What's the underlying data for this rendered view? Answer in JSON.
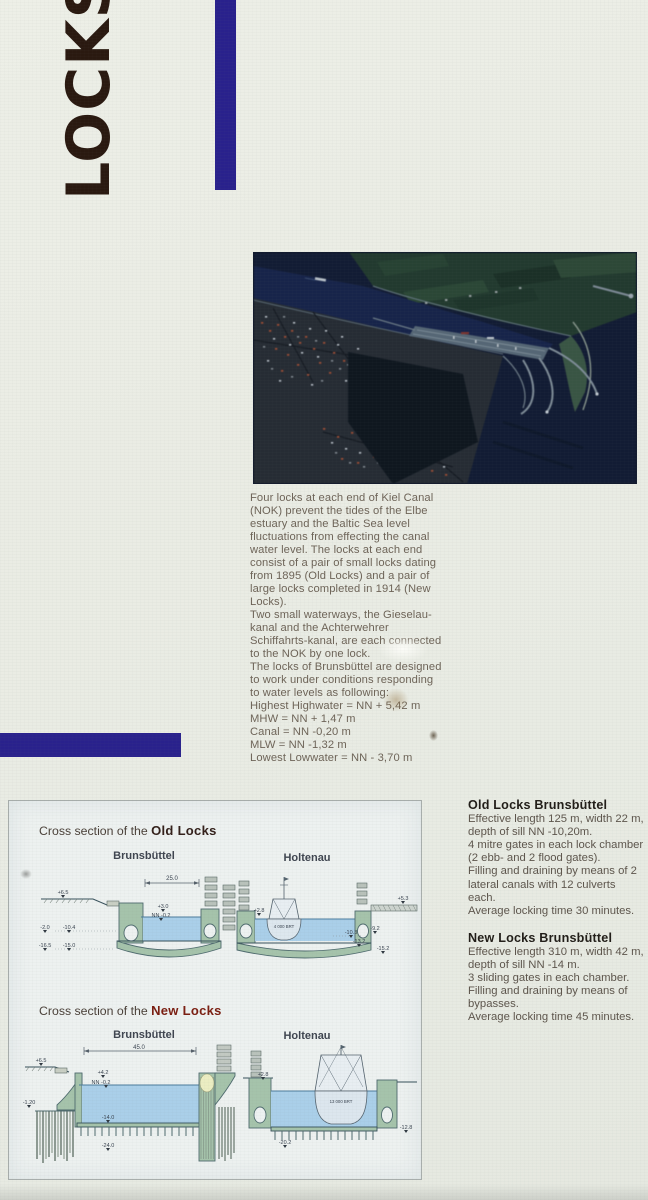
{
  "poster": {
    "title": "LOCKS"
  },
  "colors": {
    "accent_bar": "#29218c",
    "title_text": "#2a1910",
    "old_heading": "#33201a",
    "new_heading": "#7a1d10",
    "diagram_wall": "#a5c3ab",
    "diagram_water": "#aacfe9",
    "photo_water": "#16223f"
  },
  "intro": {
    "lines": [
      "Four locks at each end of Kiel Canal",
      "(NOK) prevent the tides of the Elbe",
      "estuary and the Baltic Sea level",
      "fluctuations from effecting the canal",
      "water level. The locks at each end",
      "consist of a pair of small locks dating",
      "from 1895 (Old Locks) and a pair of",
      "large locks completed in 1914 (New",
      "Locks).",
      "Two small waterways, the Gieselau-",
      "kanal and the Achterwehrer",
      "Schiffahrts-kanal, are each connected",
      "to the NOK by one lock.",
      "The locks of Brunsbüttel are designed",
      "to work under conditions responding",
      "to water levels as following:"
    ],
    "levels": [
      "Highest Highwater = NN + 5,42 m",
      "MHW = NN + 1,47 m",
      "Canal = NN -0,20 m",
      "MLW = NN -1,32 m",
      "Lowest Lowwater = NN - 3,70 m"
    ]
  },
  "info": {
    "old": {
      "heading": "Old Locks Brunsbüttel",
      "lines": [
        "Effective length 125 m, width 22 m,",
        "depth of sill NN -10,20m.",
        "4 mitre gates in each lock chamber",
        "(2 ebb- and 2 flood gates).",
        "Filling and draining by means of 2",
        "lateral canals with 12 culverts each.",
        "Average locking time 30 minutes."
      ]
    },
    "new": {
      "heading": "New Locks Brunsbüttel",
      "lines": [
        "Effective length 310 m, width 42 m,",
        "depth of sill NN -14 m.",
        "3 sliding gates in each chamber.",
        "Filling and draining by means of",
        "bypasses.",
        "Average locking time 45 minutes."
      ]
    }
  },
  "diagram": {
    "old": {
      "title_prefix": "Cross section of the ",
      "title_bold": "Old Locks",
      "col_left": "Brunsbüttel",
      "col_right": "Holtenau",
      "bb": {
        "dim": "25.0",
        "ground": "+6.5",
        "wall_top": "+3.0",
        "water": "NN -0.2",
        "d1": "-2.0",
        "d2": "-10.4",
        "d3": "-16.5",
        "d4": "-15.0"
      },
      "ho": {
        "quay": "+2.8",
        "ship": "4 000 BRT",
        "bridge": "+5.3",
        "d1": "-10.3",
        "d2": "-9.2",
        "d3": "-13.2",
        "d4": "-15.2"
      }
    },
    "new": {
      "title_prefix": "Cross section of the ",
      "title_bold": "New Locks",
      "col_left": "Brunsbüttel",
      "col_right": "Holtenau",
      "bb": {
        "dim": "45.0",
        "ground": "+6.5",
        "wall_top": "+4.2",
        "water": "NN -0.2",
        "left": "-1.20",
        "floor": "-14.0",
        "piles": "-24.0"
      },
      "ho": {
        "quay": "+2.8",
        "ship": "13 000 BRT",
        "floor": "-20.2",
        "right": "-12.8"
      }
    }
  }
}
